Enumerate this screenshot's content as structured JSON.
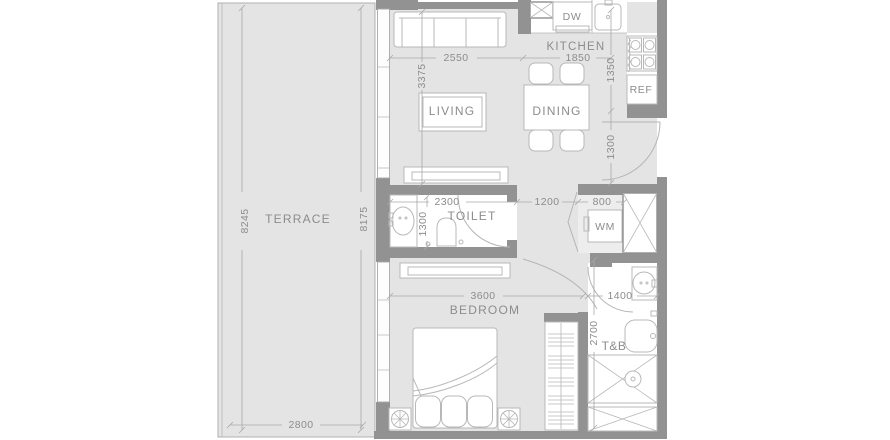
{
  "colors": {
    "floor": "#e4e4e4",
    "wall": "#929292",
    "outline": "#b8b8b8",
    "window": "#a8a8a8",
    "dim": "#a9a9a9",
    "terrace_line": "#b0b0b0",
    "text": "#8c8c8c"
  },
  "labels": {
    "terrace": "TERRACE",
    "living": "LIVING",
    "dining": "DINING",
    "kitchen": "KITCHEN",
    "toilet": "TOILET",
    "bedroom": "BEDROOM",
    "tb": "T&B",
    "dw": "DW",
    "ref": "REF",
    "wm": "WM"
  },
  "dimensions": {
    "terrace_length": "8245",
    "interior_length": "8175",
    "terrace_width": "2800",
    "living_width": "2550",
    "living_depth": "3375",
    "kitchen_width": "1850",
    "kitchen_depth": "1350",
    "entry_depth": "1300",
    "toilet_width": "2300",
    "toilet_depth": "1300",
    "hall_width": "1200",
    "wm_width": "800",
    "bedroom_width": "3600",
    "tb_width": "1400",
    "tb_depth": "2700"
  }
}
